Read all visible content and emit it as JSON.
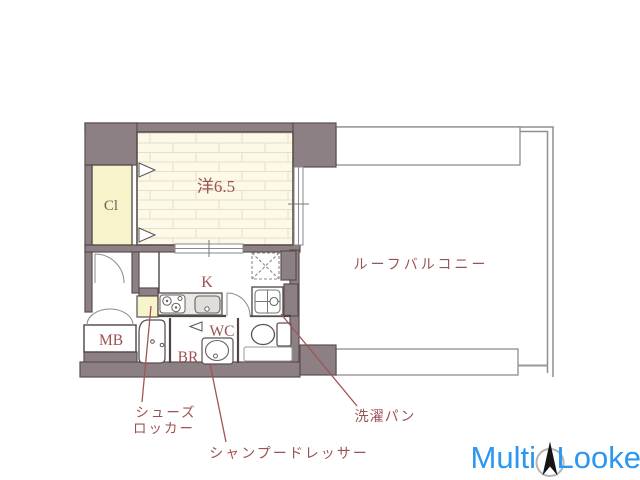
{
  "plan": {
    "rooms": {
      "main": {
        "label": "洋6.5"
      },
      "closet": {
        "label": "Cl"
      },
      "kitchen": {
        "label": "K"
      },
      "toilet": {
        "label": "WC"
      },
      "bathroom": {
        "label": "BR"
      },
      "meter_box": {
        "label": "MB"
      },
      "balcony": {
        "label": "ルーフバルコニー"
      }
    },
    "annotations": {
      "shoe_locker_line1": "シューズ",
      "shoe_locker_line2": "ロッカー",
      "shampoo_dresser": "シャンプードレッサー",
      "washing_pan": "洗濯パン"
    },
    "colors": {
      "wall": "#8d8084",
      "wall_outline": "#5a4f4f",
      "room_floor": "#fcf9e9",
      "brick_line": "#e8e0c4",
      "closet_fill": "#f7f3cb",
      "label_maroon": "#9c5252",
      "closet_label_gray": "#6e6260",
      "leader_red": "#a05454",
      "balcony_line": "#8f8f8f"
    }
  },
  "watermark": {
    "brand_left": "Multi",
    "brand_right": "Looker",
    "logo_blue": "#2b97f1",
    "icon": "compass-needle-icon"
  }
}
